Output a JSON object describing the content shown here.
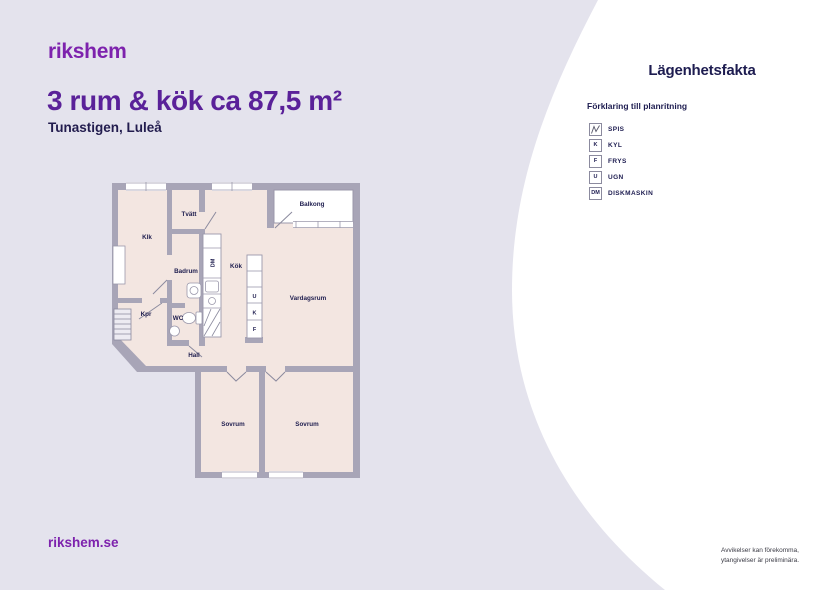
{
  "header": {
    "logo": "rikshem",
    "title": "3 rum & kök ca 87,5 m²",
    "subtitle": "Tunastigen, Luleå"
  },
  "facts": {
    "heading": "Lägenhetsfakta",
    "legend": {
      "title": "Förklaring till planritning",
      "items": [
        {
          "symbol": "",
          "label": "SPIS"
        },
        {
          "symbol": "K",
          "label": "KYL"
        },
        {
          "symbol": "F",
          "label": "FRYS"
        },
        {
          "symbol": "U",
          "label": "UGN"
        },
        {
          "symbol": "DM",
          "label": "DISKMASKIN"
        }
      ]
    }
  },
  "floorplan": {
    "rooms": {
      "klk": "Klk",
      "tvatt": "Tvätt",
      "badrum": "Badrum",
      "kok": "Kök",
      "kpr": "Kpr",
      "wc": "WC",
      "hall": "Hall",
      "vardagsrum": "Vardagsrum",
      "balkong": "Balkong",
      "sovrum_left": "Sovrum",
      "sovrum_right": "Sovrum"
    },
    "appliances": {
      "dishwasher": "DM",
      "oven": "U",
      "fridge": "K",
      "freezer": "F"
    }
  },
  "footer": {
    "site": "rikshem.se",
    "disclaimer_line1": "Avvikelser kan förekomma,",
    "disclaimer_line2": "ytangivelser är preliminära."
  },
  "colors": {
    "background": "#E4E3ED",
    "panel": "#FFFFFF",
    "brand_purple": "#7D22AD",
    "title_purple": "#5A2199",
    "navy": "#1D1C50",
    "wall_gray": "#A8A5B7",
    "room_fill": "#F3E6E1"
  }
}
